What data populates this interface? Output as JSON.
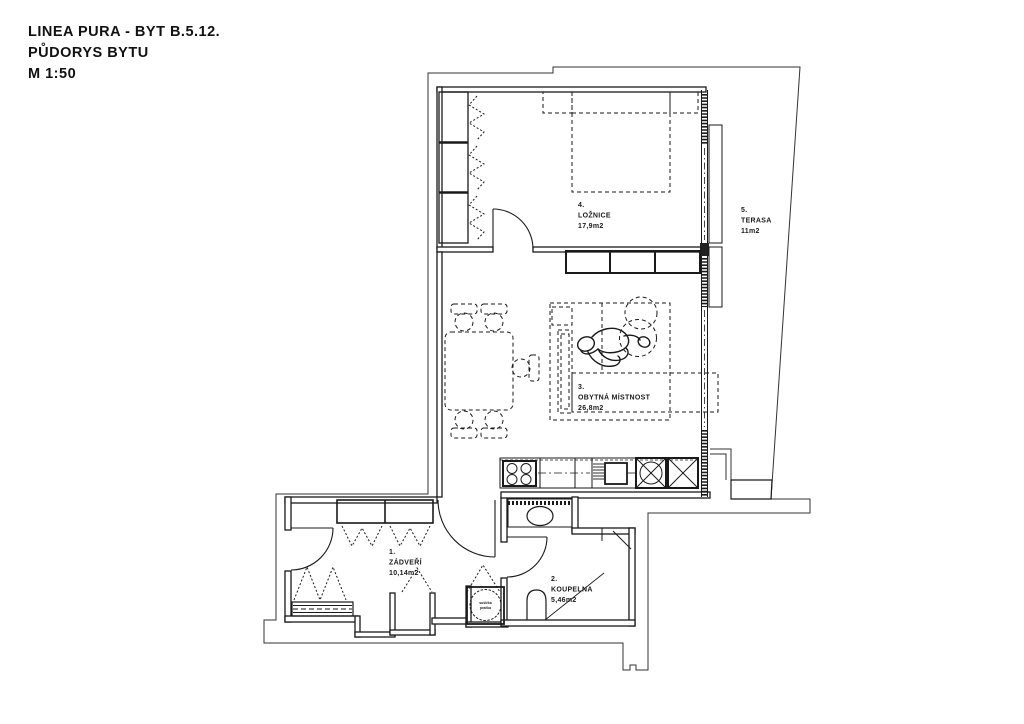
{
  "title": {
    "line1": "LINEA PURA - BYT B.5.12.",
    "line2": "PŮDORYS BYTU",
    "line3": "M 1:50"
  },
  "rooms": [
    {
      "number": "1.",
      "name": "ZÁDVEŘÍ",
      "area": "10,14m2"
    },
    {
      "number": "2.",
      "name": "KOUPELNA",
      "area": "5,46m2"
    },
    {
      "number": "3.",
      "name": "OBYTNÁ MÍSTNOST",
      "area": "26,8m2"
    },
    {
      "number": "4.",
      "name": "LOŽNICE",
      "area": "17,9m2"
    },
    {
      "number": "5.",
      "name": "TERASA",
      "area": "11m2"
    }
  ],
  "appliances": {
    "washer_line1": "sušička",
    "washer_line2": "pračka"
  },
  "colors": {
    "line": "#1a1a1a",
    "outline": "#333333",
    "background": "#ffffff"
  }
}
